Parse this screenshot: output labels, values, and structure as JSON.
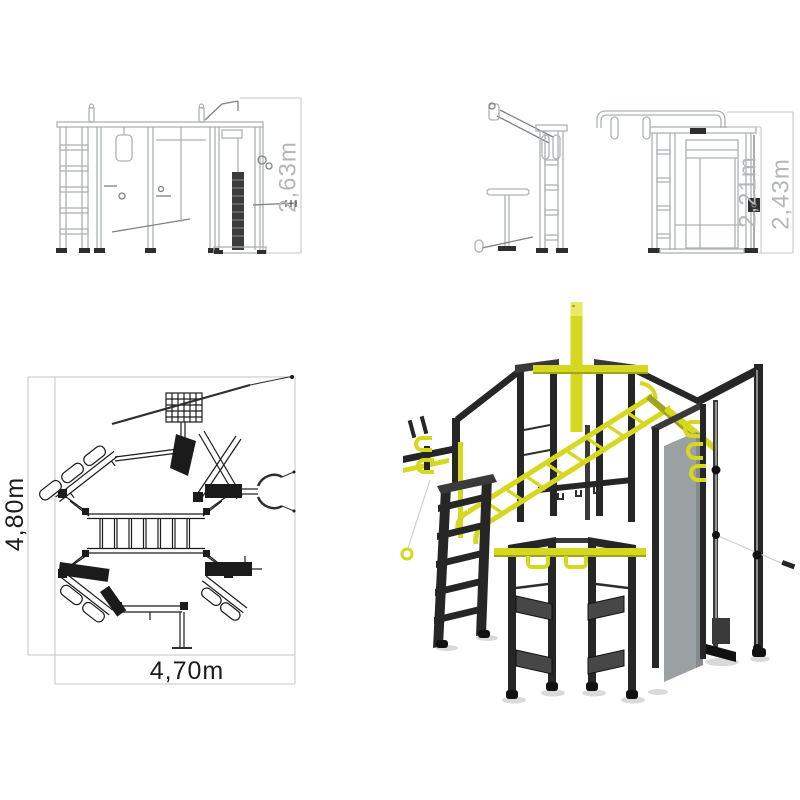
{
  "views": {
    "front_elevation": {
      "dimensions": [
        {
          "label": "2,63m"
        }
      ]
    },
    "side_elevation": {
      "dimensions": [
        {
          "label": "2,21m"
        },
        {
          "label": "2,43m"
        }
      ]
    },
    "plan_view": {
      "dimensions": [
        {
          "label": "4,80m"
        },
        {
          "label": "4,70m"
        }
      ]
    },
    "iso_render": {}
  },
  "colors": {
    "bg": "#ffffff",
    "accent_yellow": "#d6d71f",
    "accent_yellow_dark": "#a2a318",
    "accent_yellow_light": "#e9ea62",
    "frame_black": "#262626",
    "frame_black_light": "#3a3a3a",
    "frame_black_dark": "#111111",
    "panel_gray": "#9ba0a2",
    "step_gray": "#474747",
    "art_gray": "#aeb2b4",
    "art_gray_dark": "#7d8183",
    "art_black": "#2e2e2e",
    "dim_gray": "#b4b7b9",
    "plan_black": "#1b1b1b",
    "plan_box_gray": "#c6c8ca",
    "cable_gray": "#cfcfcf",
    "shadow_gray": "#d9d9d9"
  }
}
